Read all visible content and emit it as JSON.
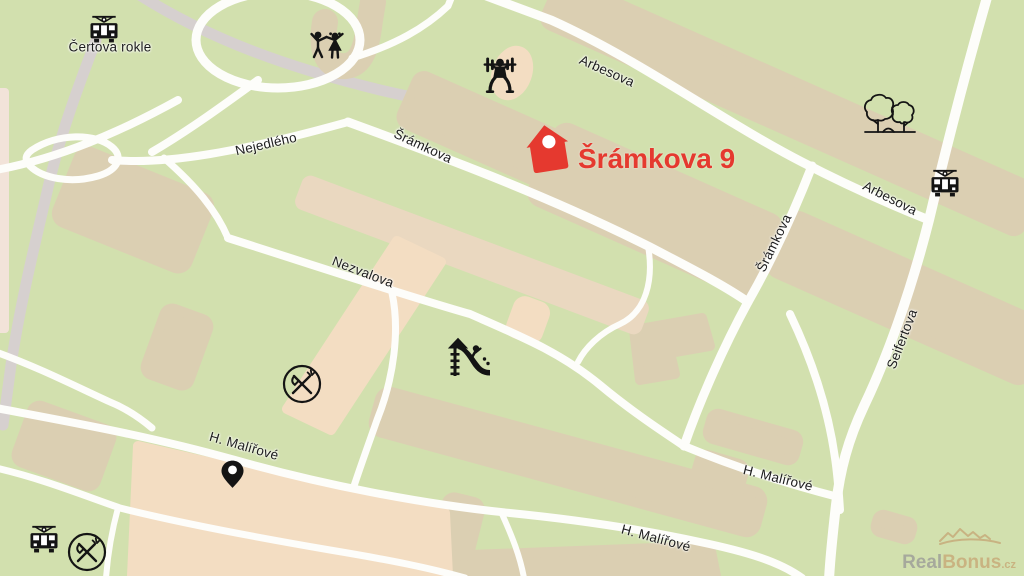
{
  "place": {
    "marker_label": "Šrámkova 9"
  },
  "pois": {
    "certova_rokle": "Čertova rokle"
  },
  "streets": {
    "arbesova": "Arbesova",
    "nejedleho": "Nejedlého",
    "sramkova": "Šrámkova",
    "nezvalova": "Nezvalova",
    "seifertova": "Seifertova",
    "h_malirove": "H. Malířové"
  },
  "watermark": {
    "part1": "Real",
    "part2": "Bonus",
    "tld": ".cz"
  },
  "icons": [
    "tram-icon",
    "tram-icon",
    "tram-icon",
    "children-playing-icon",
    "weightlifter-icon",
    "trees-icon",
    "playground-slide-icon",
    "restaurant-icon",
    "restaurant-icon",
    "location-pin-icon",
    "house-marker-icon",
    "realbonus-roofs-logo"
  ],
  "colors": {
    "map_background": "#d2e0ae",
    "building_tan": "#dbcfb2",
    "building_peach": "#f3ddc2",
    "building_rose": "#ead8c0",
    "road_white": "#fdfdfa",
    "road_gray": "#d6d0cf",
    "marker_red": "#e5392f",
    "icon_black": "#141414",
    "watermark_gray": "#9c9c98",
    "watermark_tan": "#c7a977"
  }
}
